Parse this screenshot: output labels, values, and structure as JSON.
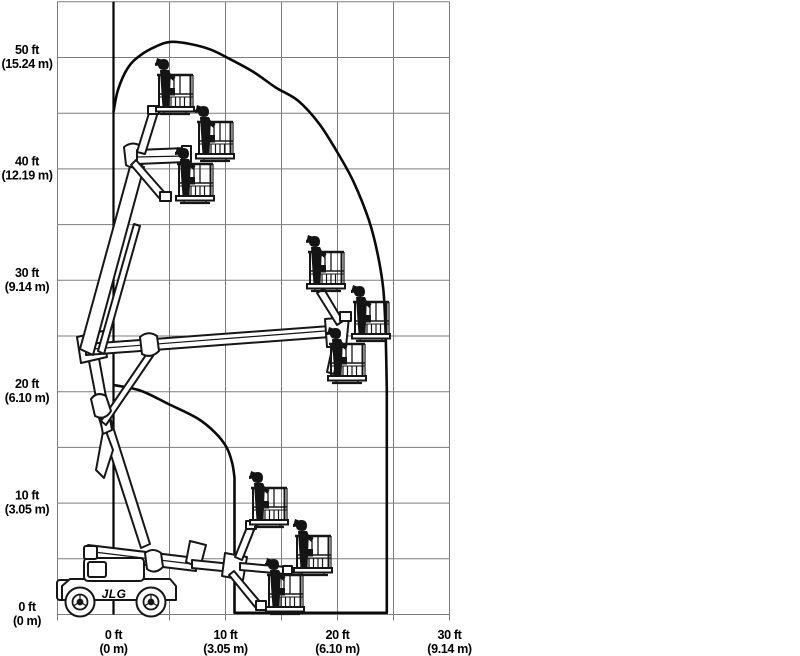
{
  "chart_data": {
    "type": "area",
    "description": "Articulating boom lift reach / range-of-motion envelope diagram with machine positions",
    "grid": {
      "show": true,
      "step_ft": 5,
      "x_range_ft": [
        -5,
        30
      ],
      "y_range_ft": [
        0,
        55
      ]
    },
    "x_axis": {
      "ticks": [
        {
          "value_ft": 0,
          "line1": "0 ft",
          "line2": "(0 m)"
        },
        {
          "value_ft": 10,
          "line1": "10 ft",
          "line2": "(3.05 m)"
        },
        {
          "value_ft": 20,
          "line1": "20 ft",
          "line2": "(6.10 m)"
        },
        {
          "value_ft": 30,
          "line1": "30 ft",
          "line2": "(9.14 m)"
        }
      ]
    },
    "y_axis": {
      "ticks": [
        {
          "value_ft": 0,
          "line1": "0 ft",
          "line2": "(0 m)"
        },
        {
          "value_ft": 10,
          "line1": "10 ft",
          "line2": "(3.05 m)"
        },
        {
          "value_ft": 20,
          "line1": "20 ft",
          "line2": "(6.10 m)"
        },
        {
          "value_ft": 30,
          "line1": "30 ft",
          "line2": "(9.14 m)"
        },
        {
          "value_ft": 40,
          "line1": "40 ft",
          "line2": "(12.19 m)"
        },
        {
          "value_ft": 50,
          "line1": "50 ft",
          "line2": "(15.24 m)"
        }
      ]
    },
    "envelope_path_ft": [
      {
        "mode": "curve",
        "points": [
          [
            0,
            45.1
          ],
          [
            0.4,
            47.1
          ],
          [
            1.3,
            49.1
          ],
          [
            2.4,
            50.2
          ],
          [
            3.8,
            51.0
          ],
          [
            5.1,
            51.4
          ],
          [
            6.9,
            51.2
          ],
          [
            8.7,
            50.7
          ],
          [
            10.5,
            49.8
          ],
          [
            12.5,
            48.7
          ],
          [
            14.5,
            47.3
          ],
          [
            16.5,
            46.1
          ],
          [
            18.4,
            44.0
          ],
          [
            20.1,
            41.3
          ],
          [
            21.5,
            38.7
          ],
          [
            22.8,
            35.4
          ],
          [
            23.6,
            32.3
          ],
          [
            24.1,
            29.1
          ],
          [
            24.3,
            25.1
          ],
          [
            24.4,
            20.2
          ]
        ]
      },
      {
        "mode": "line",
        "points": [
          [
            24.4,
            0.15
          ],
          [
            10.8,
            0.15
          ],
          [
            10.8,
            12.3
          ]
        ]
      },
      {
        "mode": "curve",
        "points": [
          [
            10.6,
            13.6
          ],
          [
            10.1,
            15.0
          ],
          [
            9.1,
            16.3
          ],
          [
            7.5,
            17.6
          ],
          [
            4.9,
            18.9
          ],
          [
            2.4,
            20.1
          ],
          [
            0,
            20.6
          ]
        ]
      }
    ],
    "zero_reach_axis_ft": 0,
    "max_reach_ft": 24.4,
    "max_height_ft": 51.4
  },
  "machine": {
    "logo": "JLG"
  }
}
